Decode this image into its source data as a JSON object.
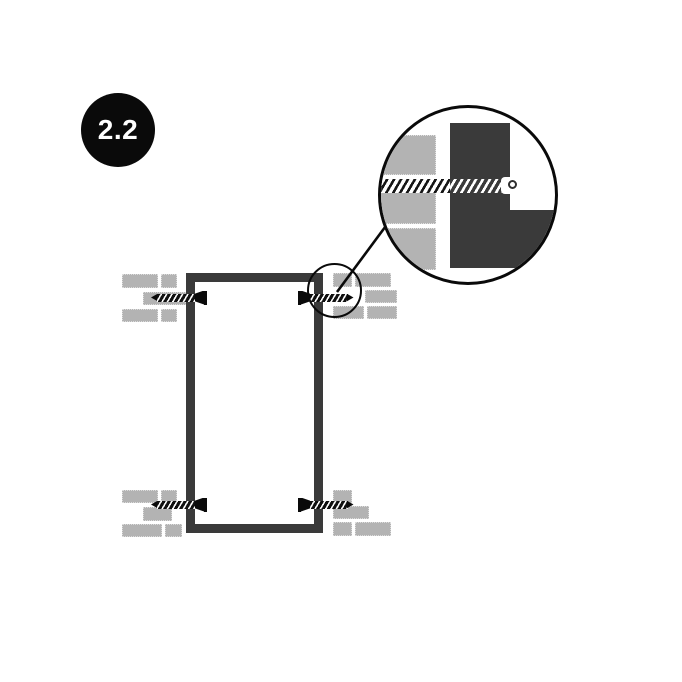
{
  "step": {
    "label": "2.2"
  },
  "colors": {
    "background": "#ffffff",
    "ink": "#0a0a0a",
    "frame": "#3a3a3a",
    "brick": "#b3b3b3"
  }
}
